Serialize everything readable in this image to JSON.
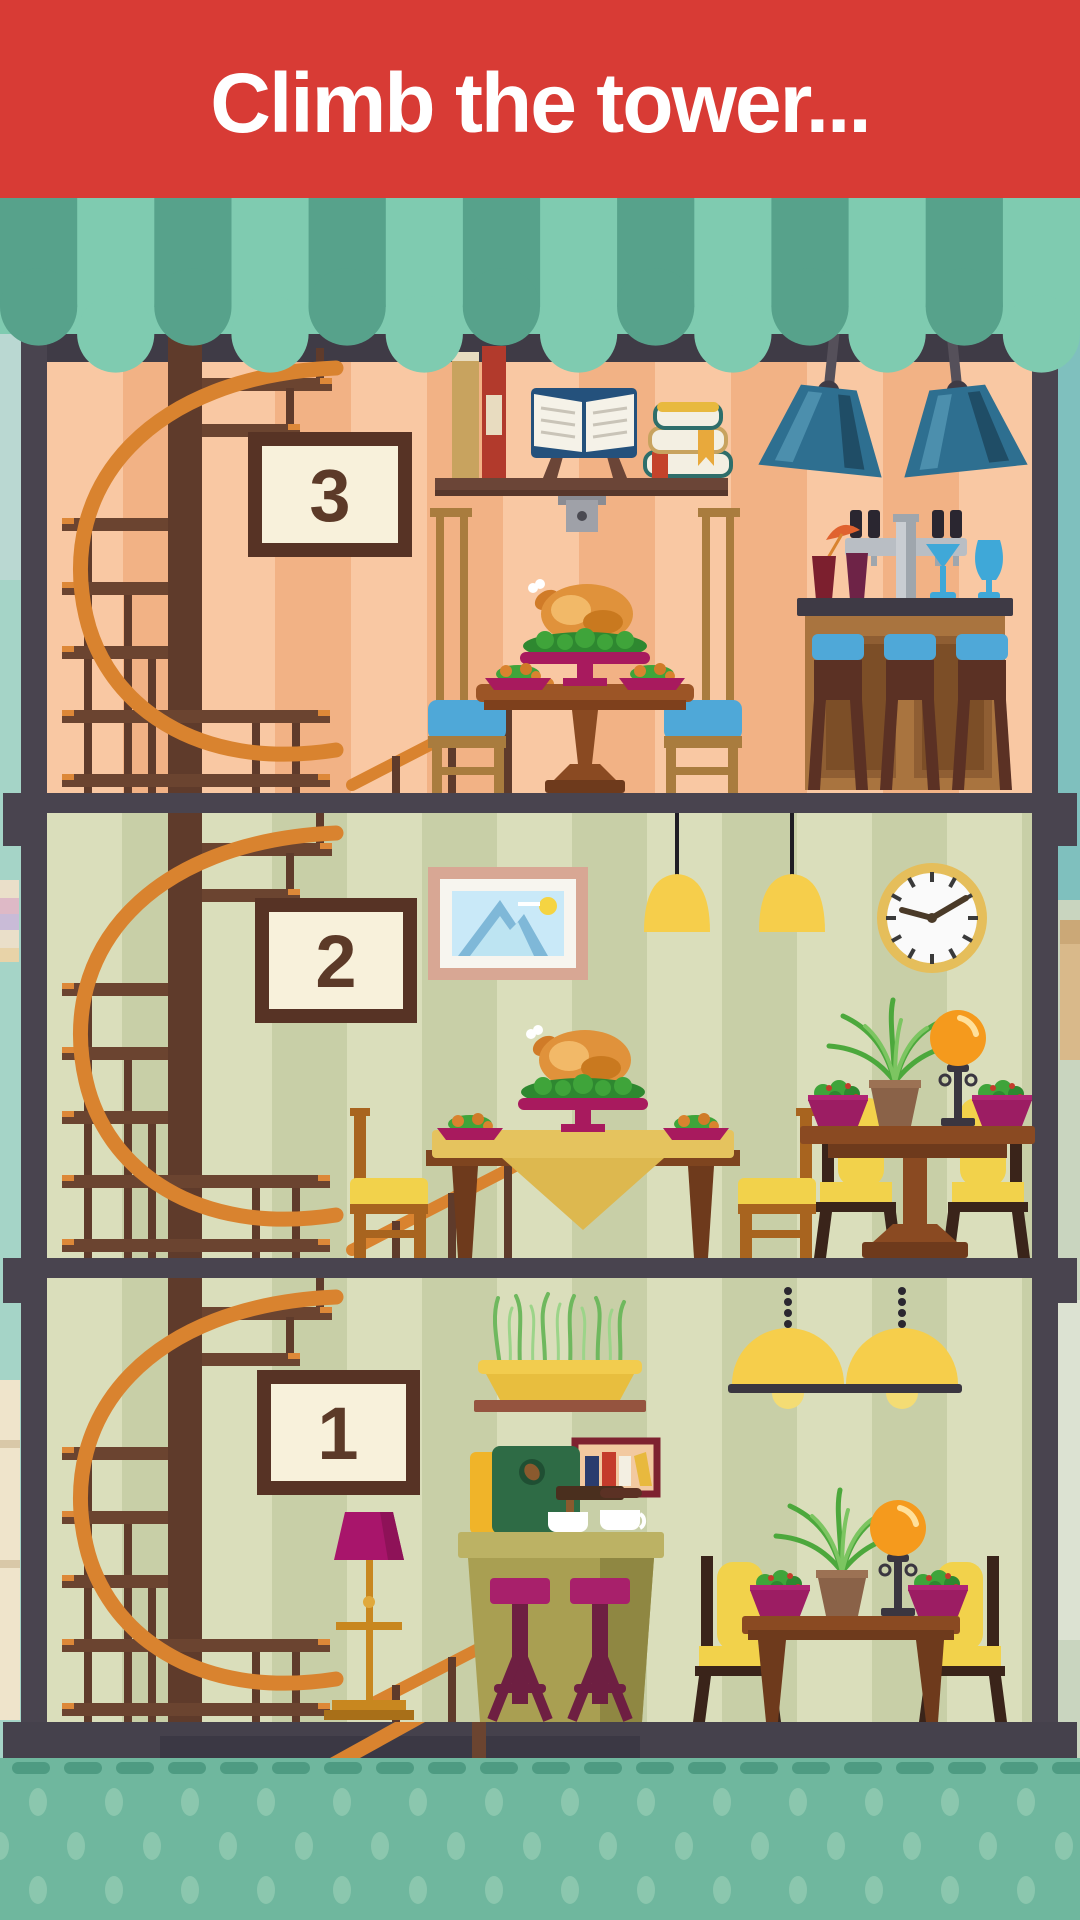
{
  "header": {
    "title": "Climb the tower...",
    "background": "#D83B35",
    "text_color": "#FFFFFF"
  },
  "floors": [
    {
      "label": "3",
      "wall_color": "#F9C8A3",
      "items": [
        "spiral-staircase",
        "floor-number-sign",
        "wall-shelf-with-books",
        "industrial-pendant-lamp",
        "industrial-pendant-lamp",
        "bar-counter-with-taps",
        "bar-stool",
        "bar-stool",
        "bar-stool",
        "round-dining-table",
        "roast-turkey-platter",
        "dining-chair-blue",
        "dining-chair-blue"
      ]
    },
    {
      "label": "2",
      "wall_color": "#DADEBB",
      "items": [
        "spiral-staircase",
        "floor-number-sign",
        "mountain-picture-frame",
        "yellow-pendant-lamp",
        "yellow-pendant-lamp",
        "wall-clock",
        "dining-table-with-tablecloth",
        "roast-turkey-platter",
        "dining-chair-yellow",
        "dining-chair-yellow",
        "pedestal-side-table",
        "salad-bowl",
        "potted-plant",
        "globe-table-lamp",
        "salad-bowl",
        "side-chair-gold",
        "side-chair-gold"
      ]
    },
    {
      "label": "1",
      "wall_color": "#DADEBB",
      "items": [
        "spiral-staircase",
        "floor-number-sign",
        "herb-planter-shelf",
        "mini-picture-frame",
        "coffee-machine",
        "coffee-bar-counter",
        "bar-stool-magenta",
        "bar-stool-magenta",
        "floor-lamp-magenta",
        "dome-pendant-lamp",
        "dome-pendant-lamp",
        "side-table",
        "salad-bowl",
        "potted-plant",
        "globe-table-lamp",
        "salad-bowl",
        "side-chair-gold",
        "side-chair-gold"
      ]
    }
  ],
  "palette": {
    "header_red": "#D83B35",
    "awning_teal_dark": "#57A28B",
    "awning_teal_light": "#7FCBB0",
    "frame_dark": "#49444F",
    "peach_stripe_light": "#F9C8A3",
    "peach_stripe_dark": "#F2B285",
    "sage_stripe_light": "#DADEBB",
    "sage_stripe_dark": "#C8CFA7",
    "ground_teal": "#6FB79E",
    "ground_dot": "#8BC7AE",
    "stair_orange": "#D9832F",
    "stair_brown": "#5F3B2B",
    "accent_magenta": "#9C1D63",
    "accent_blue": "#4FA8D8",
    "accent_yellow": "#F2D24B",
    "sign_cream": "#F8F1DB",
    "sign_frame": "#573325"
  }
}
